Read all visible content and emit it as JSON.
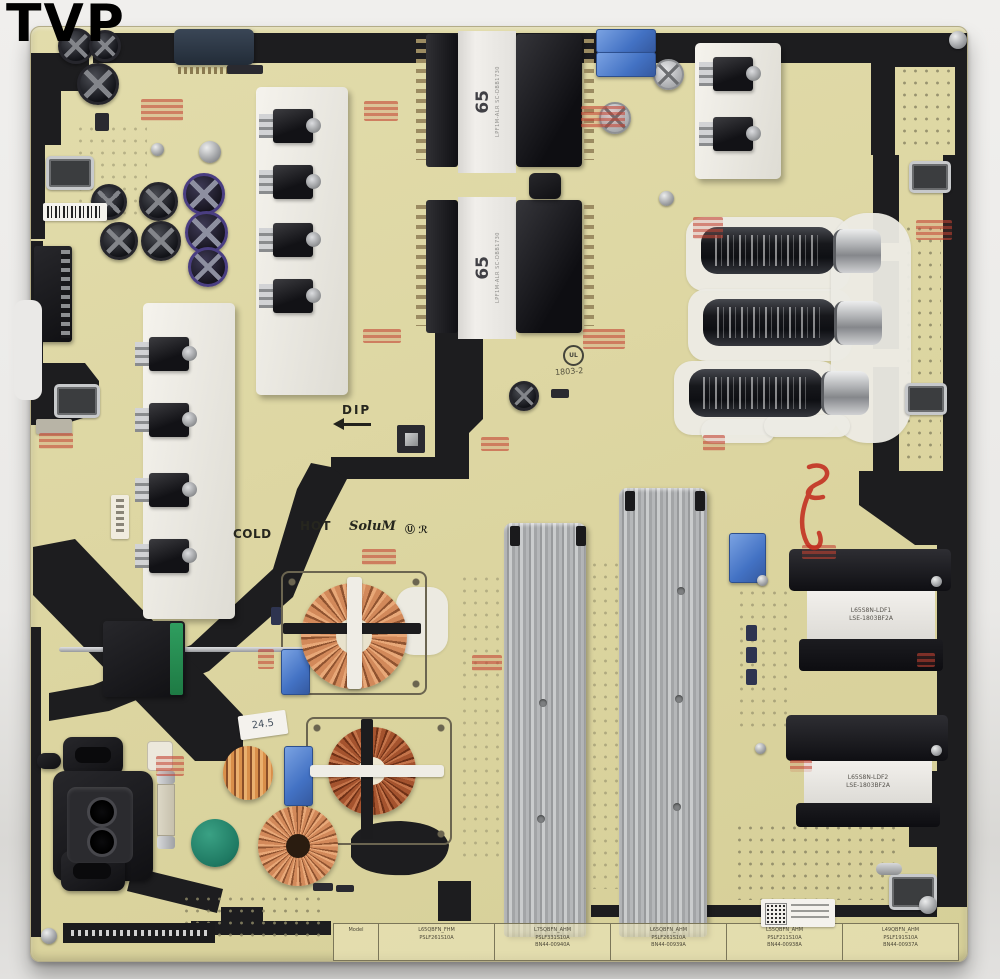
{
  "watermark": "TVP",
  "silkscreen": {
    "hot": "HOT",
    "cold": "COLD",
    "dip": "DIP",
    "brand": "SoluM",
    "cert_marks": "Ⓤ ℛ",
    "ul_mark": "UL",
    "date_code": "1803-2"
  },
  "parts": {
    "main_transformer_label": "65",
    "main_transformer_side_text": "LPF1M-ALR SC-DBB1730",
    "output_transformer_top_l1": "L65S8N-LDF1",
    "output_transformer_top_l2": "LSE-1803BF2A",
    "output_transformer_bottom_l1": "L65S8N-LDF2",
    "output_transformer_bottom_l2": "LSE-1803BF2A",
    "handwritten_sticker": "24.5"
  },
  "part_table": {
    "tag": "Model",
    "cells": [
      {
        "l1": "L65QBFN_FHM",
        "l2": "PSLF261S10A",
        "l3": ""
      },
      {
        "l1": "L75QBFN_AHM",
        "l2": "PSLF331S10A",
        "l3": "BN44-00940A"
      },
      {
        "l1": "L65QBFN_AHM",
        "l2": "PSLF261S10A",
        "l3": "BN44-00939A"
      },
      {
        "l1": "L55QBFN_AHM",
        "l2": "PSLF211S10A",
        "l3": "BN44-00938A"
      },
      {
        "l1": "L49QBFN_AHM",
        "l2": "PSLF191S10A",
        "l3": "BN44-00937A"
      }
    ]
  },
  "colors": {
    "pcb": "#ddd6a0",
    "silkscreen_black": "#1d1d1f",
    "film_cap_blue": "#4f82cf",
    "copper_coil": "#c9854f",
    "heatsink_silver": "#adb0b2",
    "thermistor_green": "#2e8f76",
    "stamp_red": "#c0453a"
  }
}
